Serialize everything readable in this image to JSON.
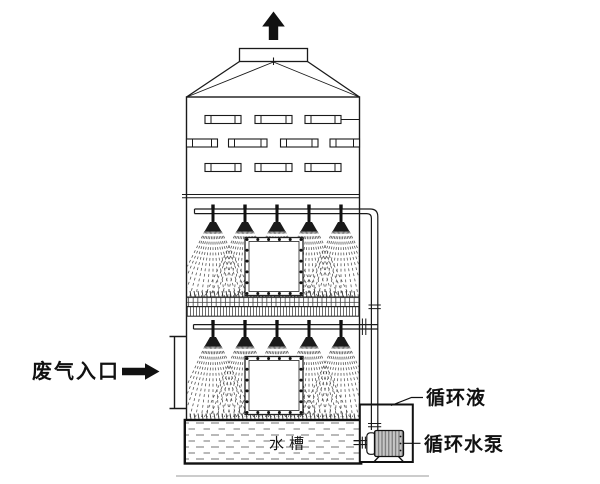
{
  "diagram": {
    "title": "spray-tower-scrubber-schematic",
    "labels": {
      "waste_gas_inlet": "废气入口",
      "circulating_liquid": "循环液",
      "circulating_pump": "循环水泵",
      "water_tank": "水槽"
    },
    "icons": {
      "outlet_arrow": "up-arrow",
      "inlet_arrow": "right-arrow"
    },
    "colors": {
      "line": "#1a1a1a",
      "water_dash": "#8f8f8f",
      "motor_fill": "#c6c6c6",
      "ground_shadow": "#cccccc",
      "background": "#ffffff"
    }
  }
}
